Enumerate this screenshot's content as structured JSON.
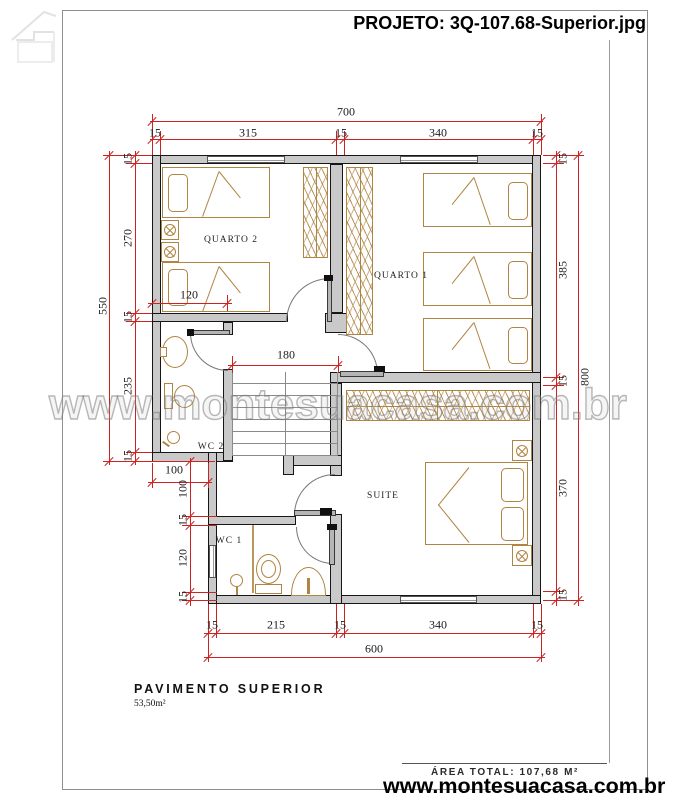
{
  "header": {
    "title": "PROJETO: 3Q-107.68-Superior.jpg"
  },
  "watermark": {
    "text": "www.montesuacasa.com.br"
  },
  "plan_title": {
    "name": "PAVIMENTO SUPERIOR",
    "area": "53,50m²"
  },
  "footer": {
    "area_total": "ÁREA TOTAL: 107,68 M²",
    "website": "www.montesuacasa.com.br"
  },
  "colors": {
    "dimension": "#cc2222",
    "wall_fill": "#c9c9c9",
    "wall_edge": "#161616",
    "furniture": "#b08442"
  },
  "rooms": [
    {
      "name": "QUARTO 2",
      "x": 231,
      "y": 240
    },
    {
      "name": "QUARTO 1",
      "x": 401,
      "y": 276
    },
    {
      "name": "SUITE",
      "x": 383,
      "y": 496
    },
    {
      "name": "WC 2",
      "x": 211,
      "y": 447
    },
    {
      "name": "WC 1",
      "x": 229,
      "y": 541
    }
  ],
  "dim_labels": [
    {
      "t": "700",
      "x": 346,
      "y": 112,
      "r": 0
    },
    {
      "t": "15",
      "x": 155,
      "y": 133,
      "r": 0
    },
    {
      "t": "315",
      "x": 248,
      "y": 133,
      "r": 0
    },
    {
      "t": "15",
      "x": 341,
      "y": 133,
      "r": 0
    },
    {
      "t": "340",
      "x": 438,
      "y": 133,
      "r": 0
    },
    {
      "t": "15",
      "x": 537,
      "y": 133,
      "r": 0
    },
    {
      "t": "120",
      "x": 189,
      "y": 295,
      "r": 0
    },
    {
      "t": "180",
      "x": 286,
      "y": 355,
      "r": 0
    },
    {
      "t": "100",
      "x": 174,
      "y": 470,
      "r": 0
    },
    {
      "t": "15",
      "x": 212,
      "y": 625,
      "r": 0
    },
    {
      "t": "215",
      "x": 276,
      "y": 625,
      "r": 0
    },
    {
      "t": "15",
      "x": 340,
      "y": 625,
      "r": 0
    },
    {
      "t": "340",
      "x": 438,
      "y": 625,
      "r": 0
    },
    {
      "t": "15",
      "x": 537,
      "y": 625,
      "r": 0
    },
    {
      "t": "600",
      "x": 374,
      "y": 649,
      "r": 0
    },
    {
      "t": "15",
      "x": 128,
      "y": 159,
      "r": -90
    },
    {
      "t": "270",
      "x": 128,
      "y": 238,
      "r": -90
    },
    {
      "t": "15",
      "x": 128,
      "y": 317,
      "r": -90
    },
    {
      "t": "235",
      "x": 128,
      "y": 386,
      "r": -90
    },
    {
      "t": "15",
      "x": 128,
      "y": 456,
      "r": -90
    },
    {
      "t": "550",
      "x": 103,
      "y": 306,
      "r": -90
    },
    {
      "t": "100",
      "x": 183,
      "y": 489,
      "r": -90
    },
    {
      "t": "15",
      "x": 183,
      "y": 520,
      "r": -90
    },
    {
      "t": "120",
      "x": 183,
      "y": 558,
      "r": -90
    },
    {
      "t": "15",
      "x": 183,
      "y": 597,
      "r": -90
    },
    {
      "t": "15",
      "x": 563,
      "y": 159,
      "r": -90
    },
    {
      "t": "385",
      "x": 563,
      "y": 270,
      "r": -90
    },
    {
      "t": "15",
      "x": 563,
      "y": 381,
      "r": -90
    },
    {
      "t": "370",
      "x": 563,
      "y": 488,
      "r": -90
    },
    {
      "t": "15",
      "x": 563,
      "y": 595,
      "r": -90
    },
    {
      "t": "800",
      "x": 585,
      "y": 377,
      "r": -90
    }
  ],
  "dim_lines": [
    {
      "o": "h",
      "x": 150,
      "y": 121,
      "l": 393,
      "ticks": [
        152,
        541
      ]
    },
    {
      "o": "h",
      "x": 150,
      "y": 139,
      "l": 393,
      "ticks": [
        152,
        160,
        336,
        344,
        533,
        541
      ]
    },
    {
      "o": "h",
      "x": 148,
      "y": 303,
      "l": 84,
      "ticks": [
        152,
        227
      ]
    },
    {
      "o": "h",
      "x": 228,
      "y": 365,
      "l": 114,
      "ticks": [
        232,
        338
      ]
    },
    {
      "o": "h",
      "x": 148,
      "y": 482,
      "l": 64,
      "ticks": [
        152,
        208
      ]
    },
    {
      "o": "h",
      "x": 204,
      "y": 633,
      "l": 341,
      "ticks": [
        208,
        216,
        336,
        344,
        533,
        541
      ]
    },
    {
      "o": "h",
      "x": 204,
      "y": 657,
      "l": 341,
      "ticks": [
        208,
        541
      ]
    },
    {
      "o": "v",
      "x": 135,
      "y": 151,
      "l": 314,
      "ticks": [
        155,
        163,
        313,
        321,
        452,
        461
      ]
    },
    {
      "o": "v",
      "x": 109,
      "y": 151,
      "l": 314,
      "ticks": [
        155,
        461
      ]
    },
    {
      "o": "v",
      "x": 190,
      "y": 458,
      "l": 148,
      "ticks": [
        461,
        516,
        525,
        592,
        600
      ]
    },
    {
      "o": "v",
      "x": 556,
      "y": 151,
      "l": 455,
      "ticks": [
        155,
        163,
        377,
        385,
        591,
        600
      ]
    },
    {
      "o": "v",
      "x": 578,
      "y": 151,
      "l": 455,
      "ticks": [
        155,
        600
      ]
    }
  ],
  "ext_lines": [
    {
      "o": "v",
      "x": 152,
      "y": 114,
      "l": 41
    },
    {
      "o": "v",
      "x": 541,
      "y": 114,
      "l": 41
    },
    {
      "o": "v",
      "x": 160,
      "y": 131,
      "l": 24
    },
    {
      "o": "v",
      "x": 336,
      "y": 131,
      "l": 24
    },
    {
      "o": "v",
      "x": 344,
      "y": 131,
      "l": 24
    },
    {
      "o": "v",
      "x": 533,
      "y": 131,
      "l": 24
    },
    {
      "o": "v",
      "x": 208,
      "y": 604,
      "l": 58
    },
    {
      "o": "v",
      "x": 541,
      "y": 604,
      "l": 58
    },
    {
      "o": "v",
      "x": 216,
      "y": 604,
      "l": 34
    },
    {
      "o": "v",
      "x": 336,
      "y": 604,
      "l": 34
    },
    {
      "o": "v",
      "x": 344,
      "y": 604,
      "l": 34
    },
    {
      "o": "v",
      "x": 533,
      "y": 604,
      "l": 34
    },
    {
      "o": "h",
      "x": 103,
      "y": 155,
      "l": 49
    },
    {
      "o": "h",
      "x": 126,
      "y": 163,
      "l": 26
    },
    {
      "o": "h",
      "x": 126,
      "y": 313,
      "l": 26
    },
    {
      "o": "h",
      "x": 126,
      "y": 321,
      "l": 26
    },
    {
      "o": "h",
      "x": 126,
      "y": 452,
      "l": 26
    },
    {
      "o": "h",
      "x": 103,
      "y": 461,
      "l": 112
    },
    {
      "o": "h",
      "x": 182,
      "y": 516,
      "l": 35
    },
    {
      "o": "h",
      "x": 182,
      "y": 525,
      "l": 35
    },
    {
      "o": "h",
      "x": 182,
      "y": 592,
      "l": 35
    },
    {
      "o": "h",
      "x": 182,
      "y": 600,
      "l": 35
    },
    {
      "o": "v",
      "x": 152,
      "y": 463,
      "l": 25
    },
    {
      "o": "v",
      "x": 208,
      "y": 463,
      "l": 25
    },
    {
      "o": "h",
      "x": 543,
      "y": 155,
      "l": 41
    },
    {
      "o": "h",
      "x": 543,
      "y": 163,
      "l": 21
    },
    {
      "o": "h",
      "x": 543,
      "y": 377,
      "l": 21
    },
    {
      "o": "h",
      "x": 543,
      "y": 385,
      "l": 21
    },
    {
      "o": "h",
      "x": 543,
      "y": 591,
      "l": 21
    },
    {
      "o": "h",
      "x": 543,
      "y": 600,
      "l": 41
    },
    {
      "o": "v",
      "x": 227,
      "y": 295,
      "l": 16
    },
    {
      "o": "v",
      "x": 232,
      "y": 356,
      "l": 17
    },
    {
      "o": "v",
      "x": 338,
      "y": 356,
      "l": 17
    }
  ]
}
